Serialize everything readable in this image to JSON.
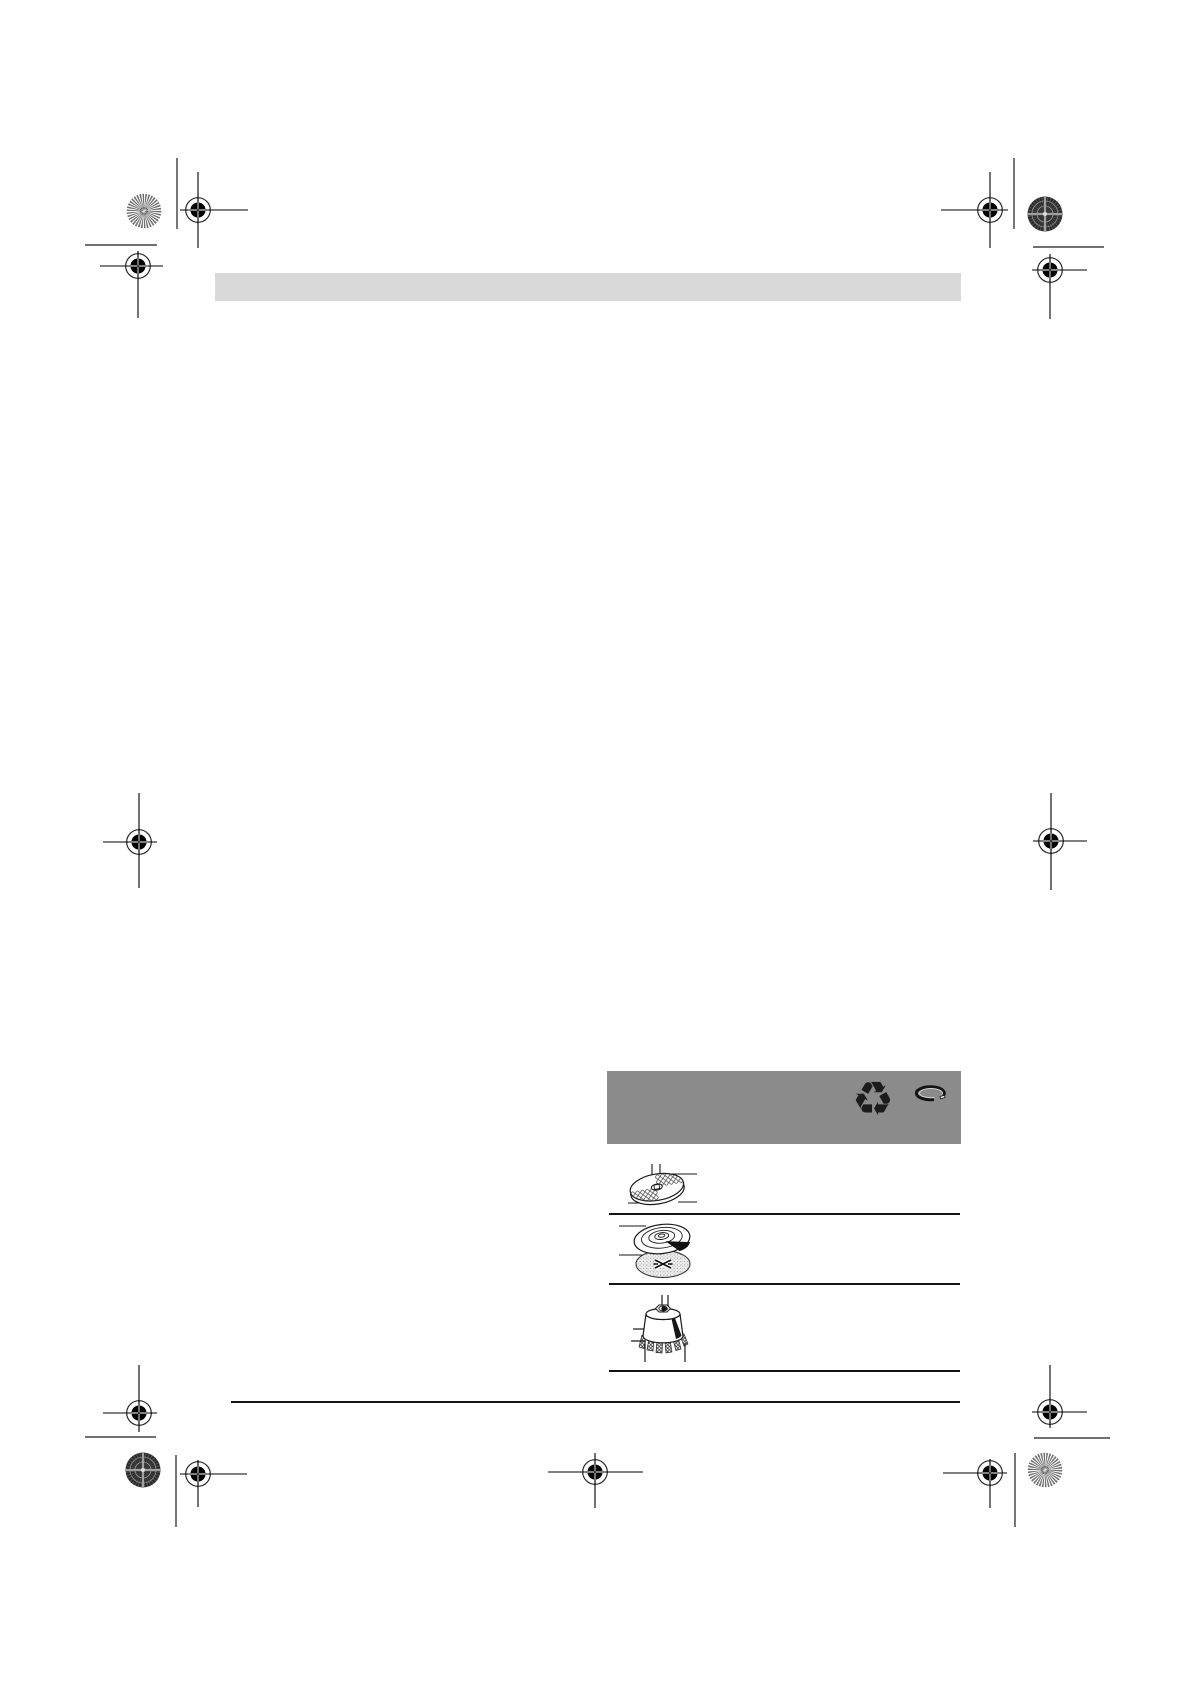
{
  "page": {
    "description": "Blank proof page of a printed instruction manual with crop and registration marks",
    "visible_text": ""
  },
  "colors": {
    "page_bg": "#ffffff",
    "header_bar": "#d9d9d9",
    "disposal_panel": "#8b8b8b",
    "line": "#141414"
  },
  "header_bar": {
    "text": ""
  },
  "disposal_panel": {
    "recycle_glyph": "♻",
    "icons": [
      {
        "name": "recycling-arrows-icon"
      },
      {
        "name": "open-ring-icon"
      }
    ]
  },
  "accessories_table": {
    "rows": [
      {
        "icon": "grinding-disc",
        "caption": ""
      },
      {
        "icon": "backing-pad-with-sanding-sheet",
        "caption": ""
      },
      {
        "icon": "wire-cup-brush",
        "caption": ""
      }
    ]
  },
  "printer_marks": {
    "registration_mark_count": 11,
    "color_patch_count": 4
  }
}
